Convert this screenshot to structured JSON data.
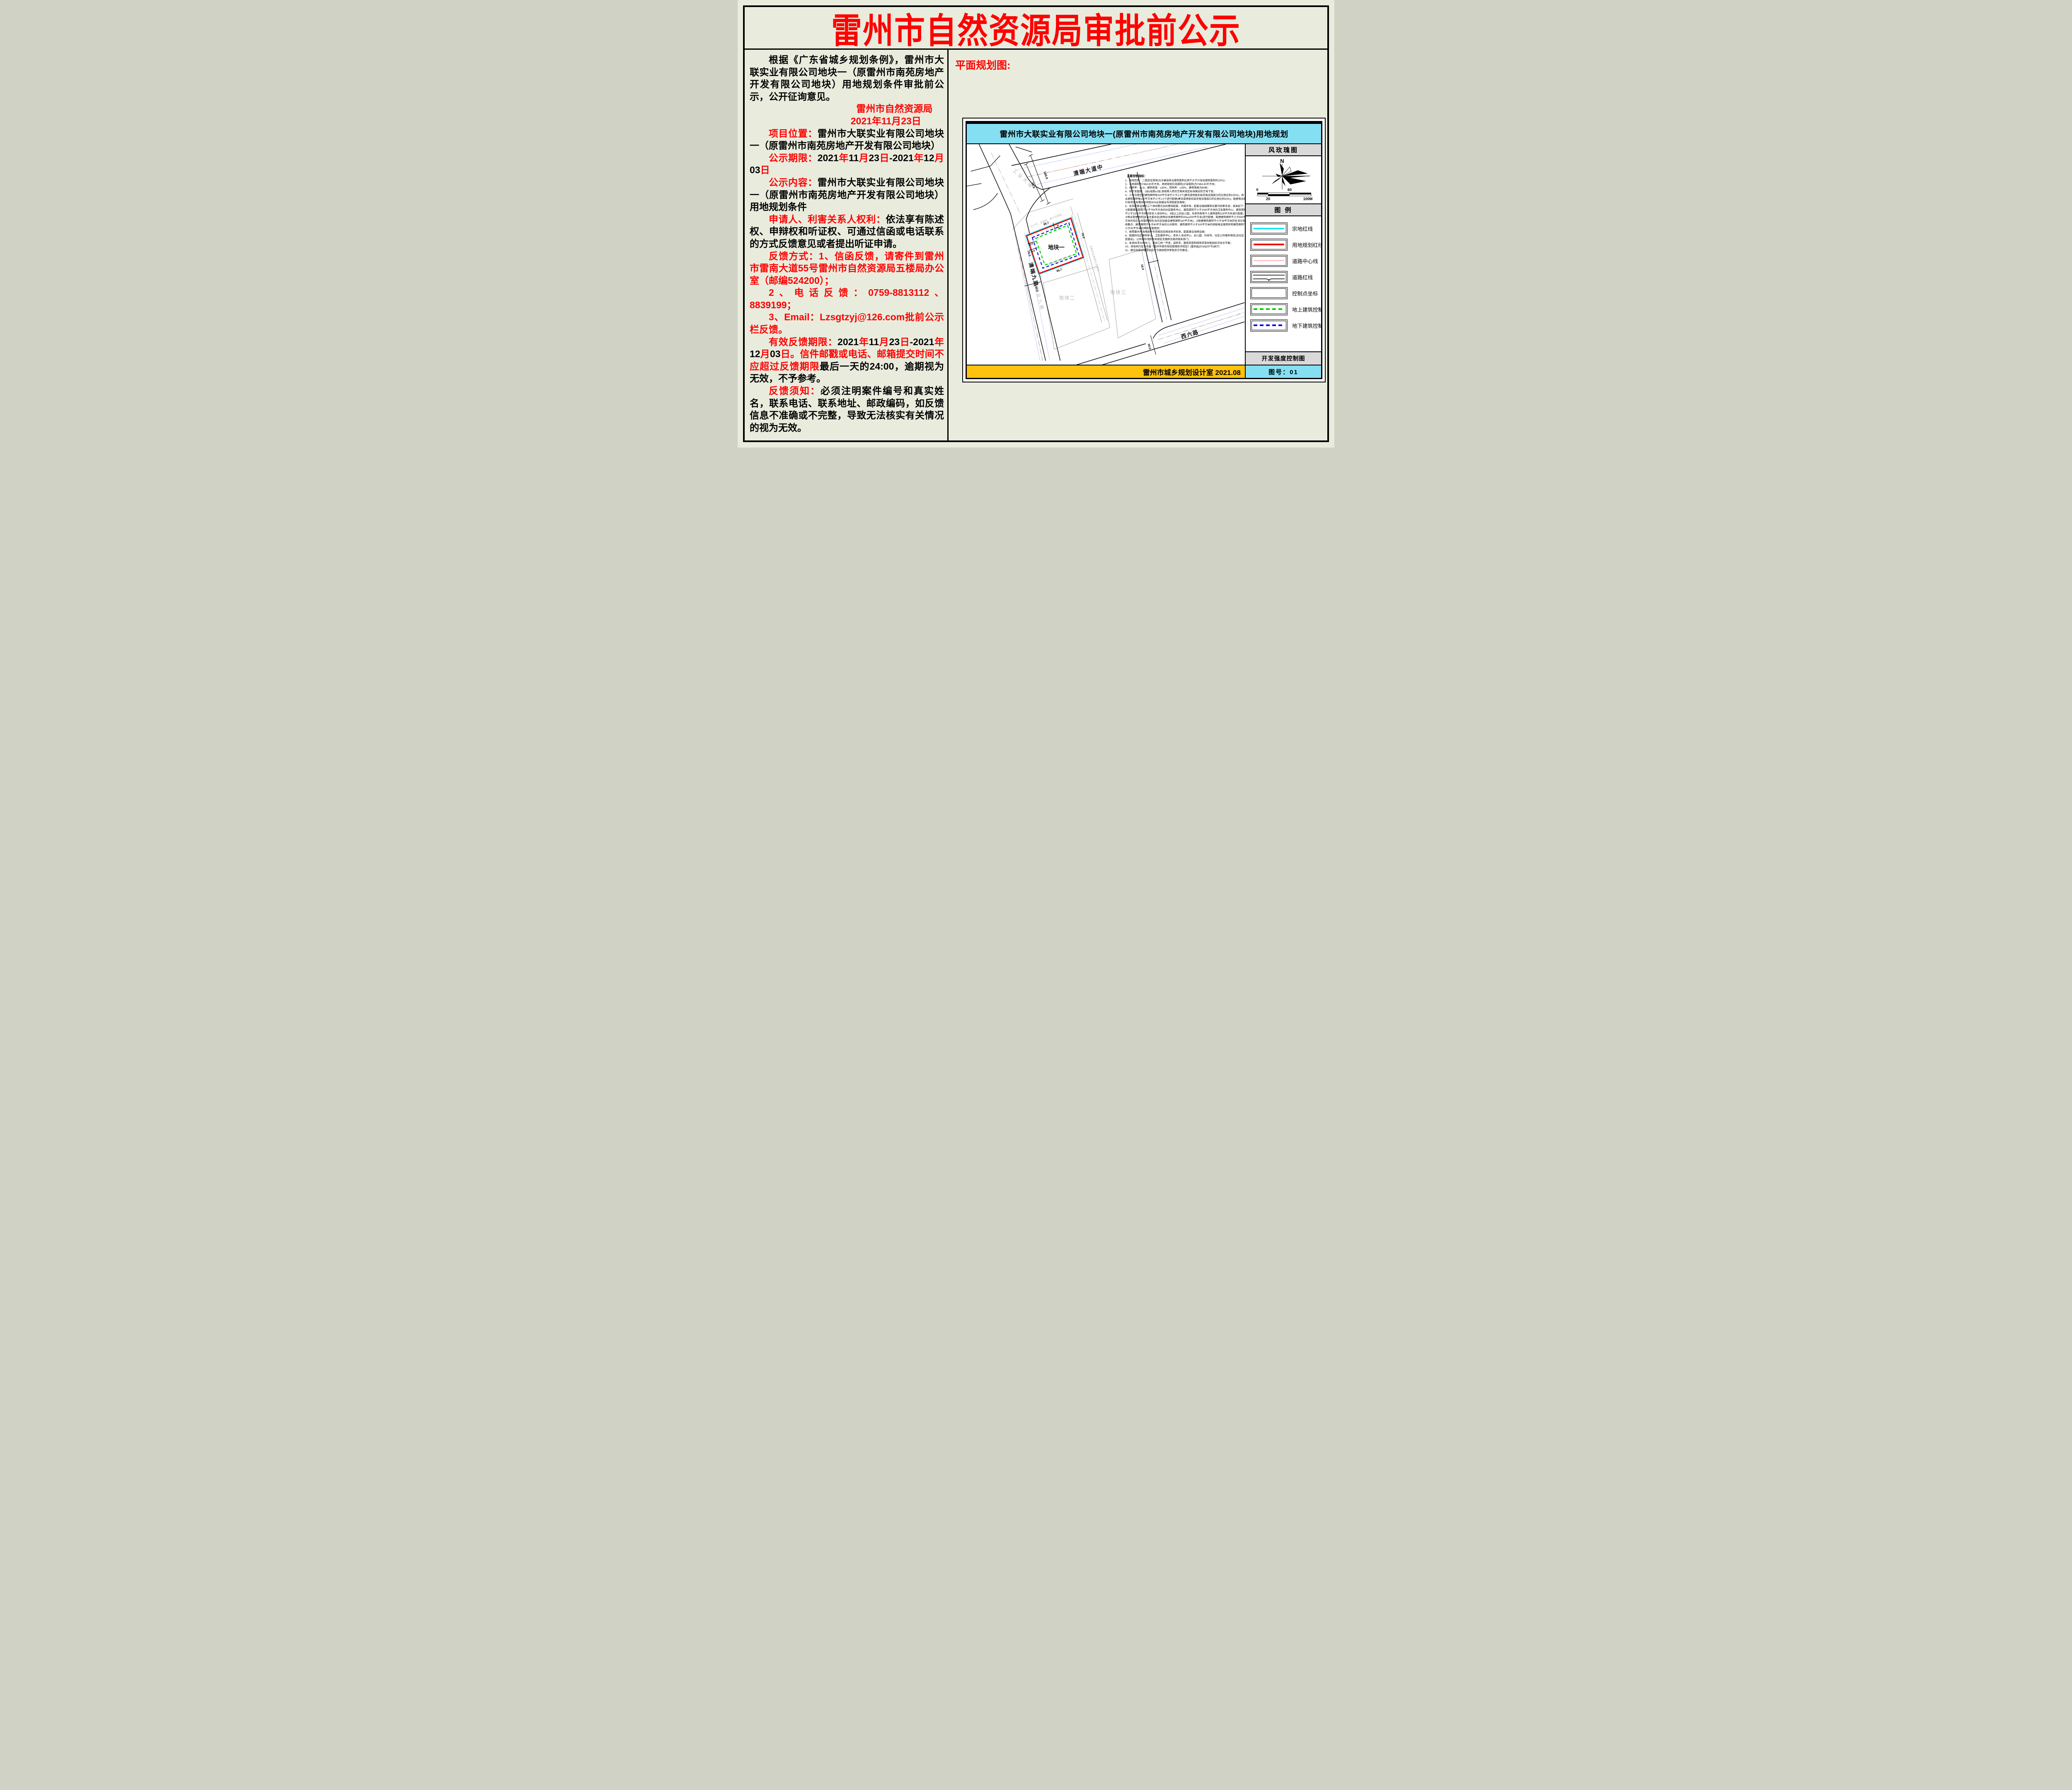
{
  "page": {
    "title": "雷州市自然资源局审批前公示",
    "plan_label": "平面规划图:"
  },
  "left_column": {
    "paragraphs": [
      {
        "indent": true,
        "runs": [
          {
            "t": "根据《广东省城乡规划条例》，雷州市大联实业有限公司地块一（原雷州市南苑房地产开发有限公司地块）用地规划条件审批前公示，公开征询意见。",
            "c": "k"
          }
        ]
      },
      {
        "align": "right",
        "rpad": "1.2em",
        "runs": [
          {
            "t": "雷州市自然资源局",
            "c": "r"
          }
        ]
      },
      {
        "align": "right",
        "rpad": "2.4em",
        "runs": [
          {
            "t": "2021年11月23日",
            "c": "r"
          }
        ]
      },
      {
        "indent": true,
        "runs": [
          {
            "t": "项目位置：",
            "c": "r"
          },
          {
            "t": "雷州市大联实业有限公司地块一（原雷州市南苑房地产开发有限公司地块）",
            "c": "k"
          }
        ]
      },
      {
        "indent": true,
        "runs": [
          {
            "t": "公示期限：",
            "c": "r"
          },
          {
            "t": "2021",
            "c": "k"
          },
          {
            "t": "年",
            "c": "r"
          },
          {
            "t": "11",
            "c": "k"
          },
          {
            "t": "月",
            "c": "r"
          },
          {
            "t": "23",
            "c": "k"
          },
          {
            "t": "日",
            "c": "r"
          },
          {
            "t": "-2021",
            "c": "k"
          },
          {
            "t": "年",
            "c": "r"
          },
          {
            "t": "12",
            "c": "k"
          },
          {
            "t": "月",
            "c": "r"
          },
          {
            "t": "03",
            "c": "k"
          },
          {
            "t": "日",
            "c": "r"
          }
        ]
      },
      {
        "indent": true,
        "runs": [
          {
            "t": "公示内容：",
            "c": "r"
          },
          {
            "t": "雷州市大联实业有限公司地块一（原雷州市南苑房地产开发有限公司地块）用地规划条件",
            "c": "k"
          }
        ]
      },
      {
        "indent": true,
        "runs": [
          {
            "t": "申请人、利害关系人权利：",
            "c": "r"
          },
          {
            "t": "依法享有陈述权、申辩权和听证权、可通过信函或电话联系的方式反馈意见或者提出听证申请。",
            "c": "k"
          }
        ]
      },
      {
        "indent": true,
        "runs": [
          {
            "t": "反馈方式：1、信函反馈，请寄件到雷州市雷南大道55号雷州市自然资源局五楼局办公室（邮编524200）；",
            "c": "r"
          }
        ]
      },
      {
        "indent": true,
        "runs": [
          {
            "t": "2、电话反馈：0759-8813112、8839199；",
            "c": "r"
          }
        ]
      },
      {
        "indent": true,
        "runs": [
          {
            "t": "3、Email：Lzsgtzyj@126.com批前公示栏反馈。",
            "c": "r"
          }
        ]
      },
      {
        "indent": true,
        "runs": [
          {
            "t": "有效反馈期限：",
            "c": "r"
          },
          {
            "t": "2021",
            "c": "k"
          },
          {
            "t": "年",
            "c": "r"
          },
          {
            "t": "11",
            "c": "k"
          },
          {
            "t": "月",
            "c": "r"
          },
          {
            "t": "23",
            "c": "k"
          },
          {
            "t": "日",
            "c": "r"
          },
          {
            "t": "-2021",
            "c": "k"
          },
          {
            "t": "年",
            "c": "r"
          },
          {
            "t": "12",
            "c": "k"
          },
          {
            "t": "月",
            "c": "r"
          },
          {
            "t": "03",
            "c": "k"
          },
          {
            "t": "日。信件邮戳或电话、邮箱提交时间不应超过反馈期限",
            "c": "r"
          },
          {
            "t": "最后一天的24:00，逾期视为无效，不予参考。",
            "c": "k"
          }
        ]
      },
      {
        "indent": true,
        "runs": [
          {
            "t": "反馈须知：",
            "c": "r"
          },
          {
            "t": "必须注明案件编号和真实姓名，联系电话、联系地址、邮政编码，如反馈信息不准确或不完整，导致无法核实有关情况的视为无效。",
            "c": "k"
          }
        ]
      }
    ]
  },
  "map": {
    "title": "雷州市大联实业有限公司地块一(原雷州市南苑房地产开发有限公司地块)用地规划",
    "footer": "雷州市城乡规划设计室  2021.08",
    "indicators": {
      "title": "主要控制指标：",
      "items": [
        "1、用地性质：二类居住用地(允许兼容商业建筑面积比例不大于计容总建筑面积的10%)；",
        "2、宗地面积为7464.60平方米，用地规划红线面积(计容面积)为7464.60平方米；",
        "3、容积率：≤2.8，建筑密度：≤30%，绿地率：≥35%，建筑限高为80米；",
        "4、地下室层数：1层≤层数≤2层,且按照人民防空相关规定标准建设防空地下室；",
        "5、小车位按住宅建筑面积每100平方米不少于1.0个(建设或预留安装充电设施接口的比例达到100%)，商业建筑面积每100平方米不少于1.0个进行配建(建设或预留安装充电设施接口的比例达到10%)；配建电动自行车停放充电场所并按30%比例建设专用智能充电桩；",
        "6、各项配套设施为三个地块整合后的整体配套，共建共享，配套设施规模和位置可统筹考虑；具体如下：①配建建筑面积不小于750平方米的社区服务中心、建筑面积不小于2000平方米的卫生服务中心、建筑面积不小于1500平方米的老年人活动中心、9班以上的幼儿园，托老所按每千人建筑面积100平方米进行配建；②物业管理用房(含业主委员会)按物业总建筑面积的2‰(≤500平方米)进行配建，配建建筑面积不小于600平方米的社区公共服务用房(含社区居委会建筑面积100平方米)；③配建建筑面积不小于38平方米的生活垃圾收集点、建筑面积不小于60平方米的公共厕所、建筑面积不小于100平方米的供配电设施用房和建筑面积不小于30平方米的网络设施用房；",
        "7、按照雷州市海绵城市专项规划及相关技术标准，配套建设海绵设施；",
        "8、配建的社区服务中心、卫生服务中心、老年人活动中心、幼儿园、托老所、社区公共服务用房(含社区居委会)、公共厕所须按有关规定无偿移交政府相关部门；",
        "9、本地块须与地块二、地块三统一开发，容积率、建筑密度和绿地率等控制指标可综合平衡；",
        "10、其他未约定条件按《雷州市城市规划管理技术规定》(雷府函[2018]297号)执行；",
        "11、建设前报详细规划设计方案按程序审批后方可建设。"
      ]
    },
    "labels": {
      "road_qingduan": "清端大道中",
      "road_gongye": "工业大道",
      "road_qingduan9": "清端九路",
      "road_gongye9": "工业九路",
      "road_xiliu": "西六路",
      "plot1": "地块一",
      "plot2": "地块二",
      "plot3": "地块三",
      "owner_north": "方小平、吴碧伟、陈少玲用地",
      "owner_plot": "大联实业有限公司用地",
      "owner_lane": "大联实业有限公司用地"
    },
    "dims": {
      "d100": "100.0",
      "d76": "76.0",
      "d30w": "30.0",
      "d30s": "30.0",
      "d18": "18.0",
      "d957t": "95.7",
      "d957b": "95.7",
      "d78l": "78.0",
      "d78r": "78.0",
      "d12": "12.0",
      "d9": "9.0",
      "d8": "8.0"
    },
    "sidebar": {
      "rose_title": "风玫瑰图",
      "north": "N",
      "scale_ticks": [
        "0",
        "20",
        "60",
        "100M"
      ],
      "legend_title": "图  例",
      "legend": [
        {
          "label": "宗地红线",
          "style": "cyan"
        },
        {
          "label": "用地规划红线",
          "style": "red"
        },
        {
          "label": "道路中心线",
          "style": "pink"
        },
        {
          "label": "道路红线",
          "style": "road"
        },
        {
          "label": "控制点坐标",
          "style": "empty"
        },
        {
          "label": "地上建筑控制线",
          "style": "green"
        },
        {
          "label": "地下建筑控制线",
          "style": "blue"
        }
      ],
      "dev_title": "开发强度控制图",
      "sheet_no": "图号：01"
    }
  },
  "colors": {
    "title_red": "#fe0000",
    "map_titlebar_cyan": "#85dff3",
    "footer_orange": "#ffc20e",
    "panel_gray": "#d9d9d9",
    "parcel_red_line": "#e80000",
    "parcel_cyan_line": "#00e5ee",
    "above_ground_green": "#00d400",
    "below_ground_blue": "#0a0af0",
    "road_center_pink": "#ffaeae"
  }
}
